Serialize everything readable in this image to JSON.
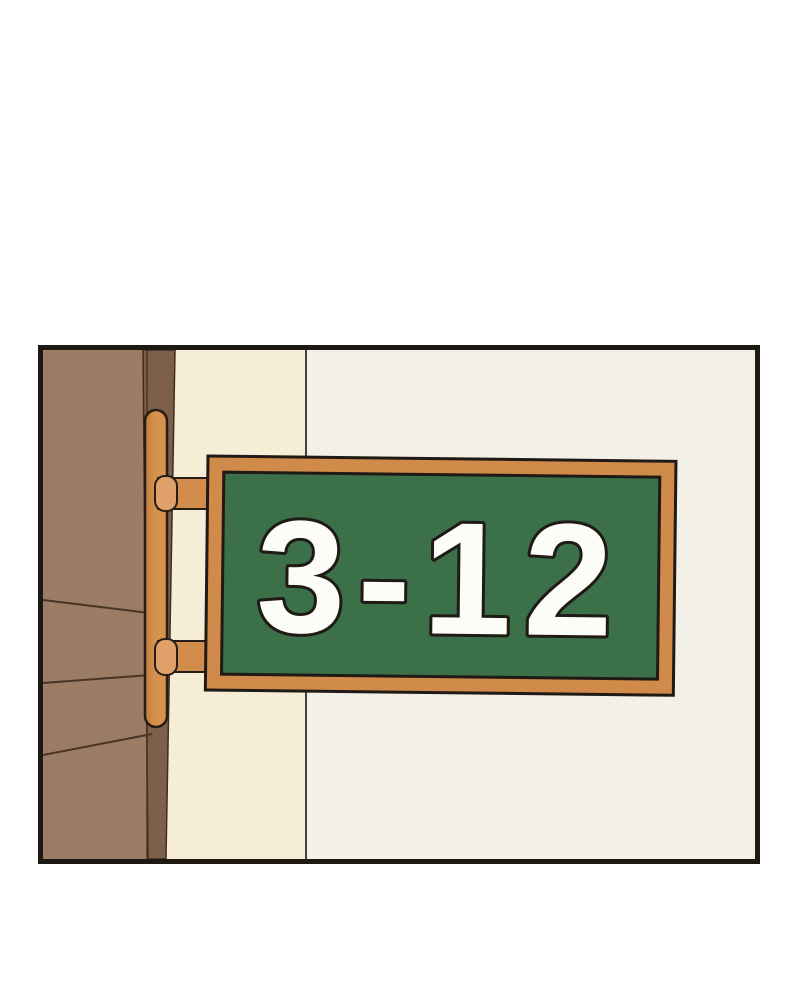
{
  "panel": {
    "sign": {
      "text": "3-12"
    },
    "colors": {
      "page_background": "#ffffff",
      "panel_border": "#1e1813",
      "wall_white": "#f2f0e7",
      "wall_cream": "#f6edd7",
      "wall_divider_line": "#474038",
      "wood_planks": "#9c7c65",
      "plank_line": "#4a3425",
      "door_frame_strip": "#7d604a",
      "bracket_orange": "#d28c4c",
      "bracket_orange_dark": "#c07c3e",
      "bracket_cap_light": "#dfa06a",
      "sign_frame_orange": "#d08a49",
      "sign_board_green": "#3b7049",
      "sign_outline": "#1f1a15",
      "sign_digits_white": "#fdfdf8"
    }
  }
}
